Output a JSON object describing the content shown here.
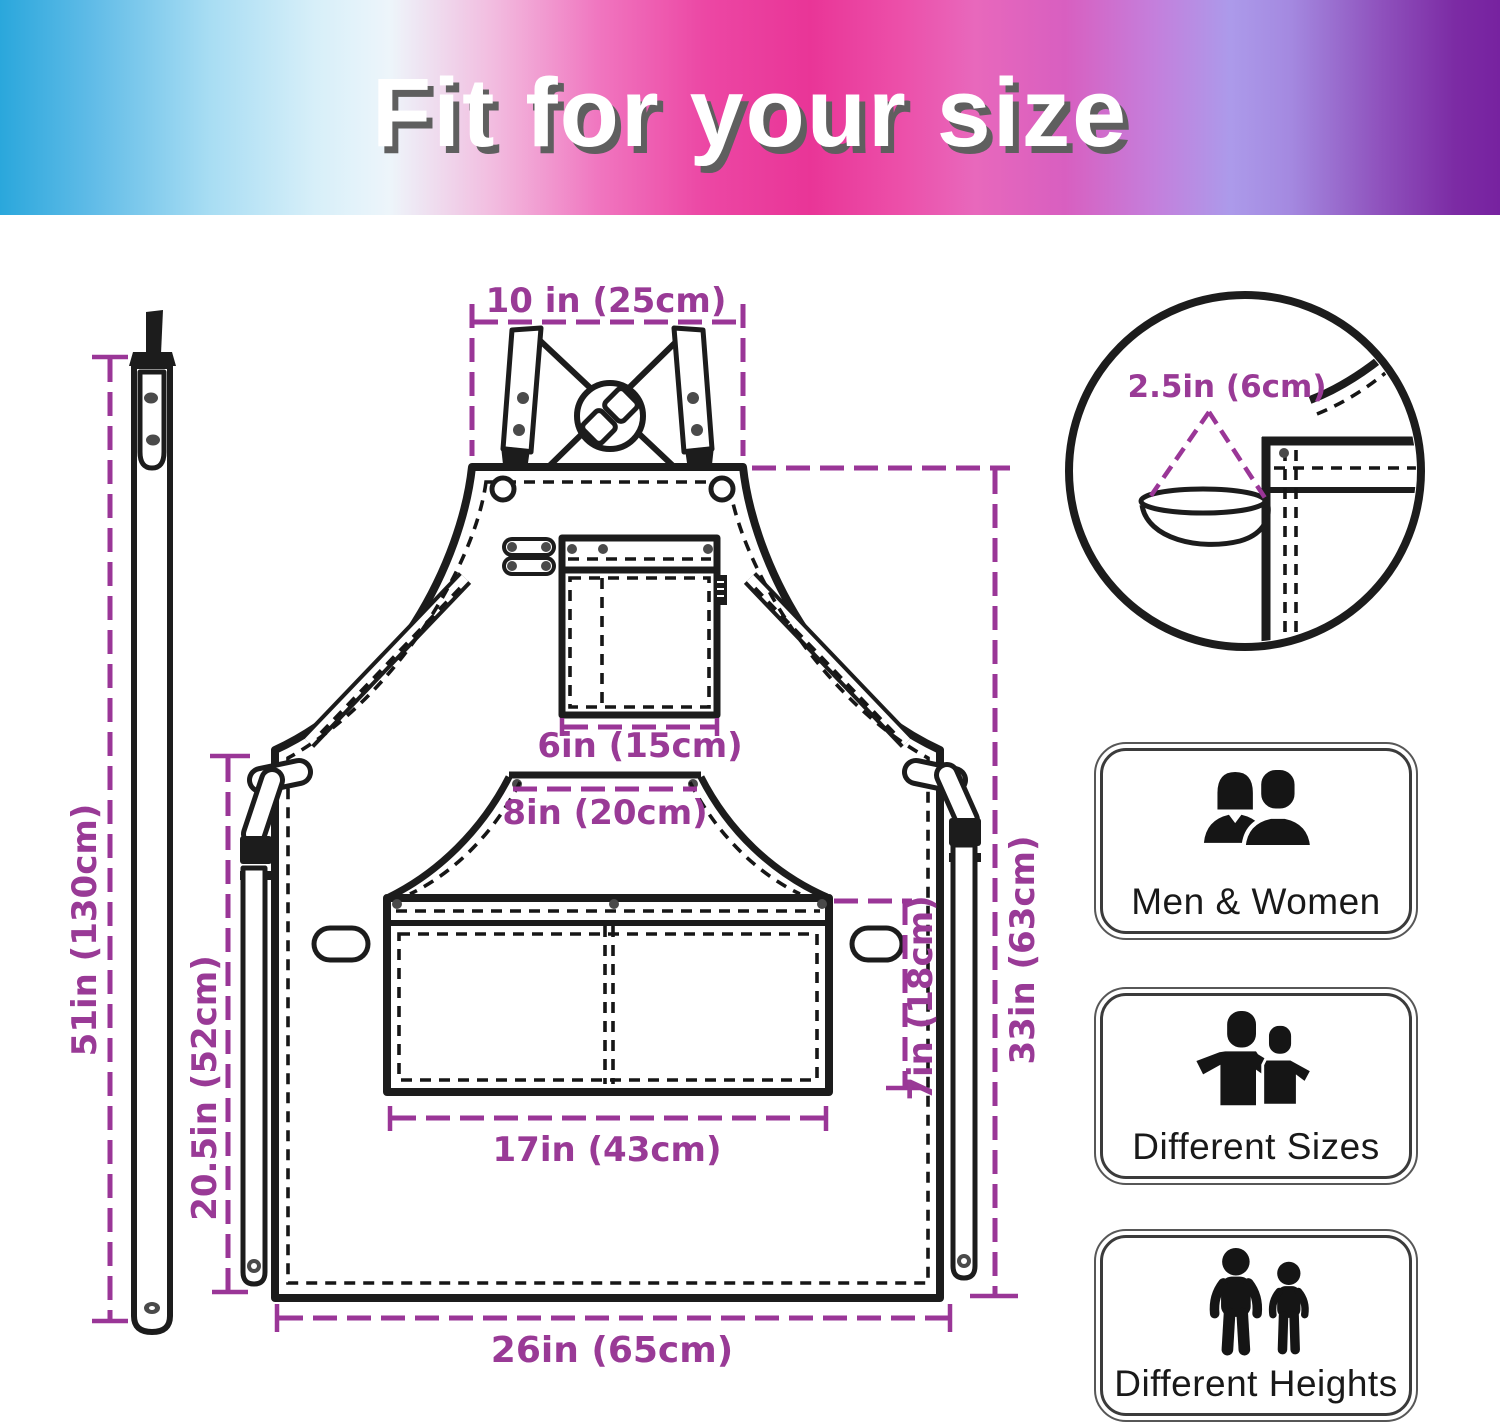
{
  "header": {
    "title": "Fit for your size"
  },
  "dimensions": {
    "strap_width_top": "10 in (25cm)",
    "loop_size": "2.5in (6cm)",
    "neck_strap_length": "51in (130cm)",
    "lower_height": "20.5in (52cm)",
    "chest_pocket_width": "6in (15cm)",
    "waist_pocket_top_width": "8in (20cm)",
    "waist_pocket_height": "7in (18cm)",
    "apron_length": "33in (63cm)",
    "waist_pocket_width": "17in (43cm)",
    "apron_width": "26in (65cm)"
  },
  "features": [
    {
      "id": "men-women",
      "label": "Men & Women"
    },
    {
      "id": "different-sizes",
      "label": "Different Sizes"
    },
    {
      "id": "different-heights",
      "label": "Different Heights"
    }
  ],
  "colors": {
    "dimension_purple": "#9A3697",
    "line_black": "#1C1C1C"
  }
}
